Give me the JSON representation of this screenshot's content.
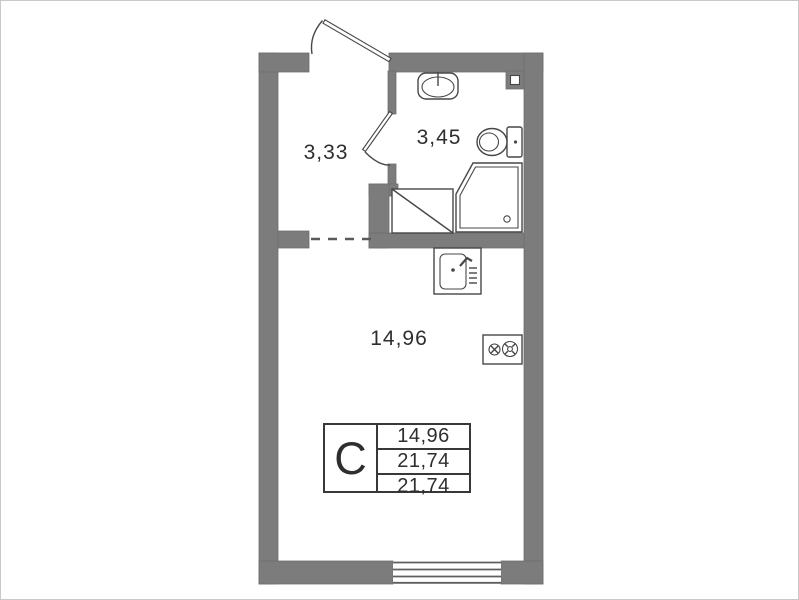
{
  "rooms": {
    "hallway": {
      "label": "3,33"
    },
    "bathroom": {
      "label": "3,45"
    },
    "living": {
      "label": "14,96"
    }
  },
  "info_table": {
    "unit_type": "С",
    "rows": [
      "14,96",
      "21,74",
      "21,74"
    ]
  },
  "colors": {
    "wall": "#7c7c7c",
    "wall_edge": "#6f6f6f",
    "line": "#474747",
    "text": "#2e2e2e",
    "background": "#ffffff",
    "frame": "#c9c9c9"
  }
}
